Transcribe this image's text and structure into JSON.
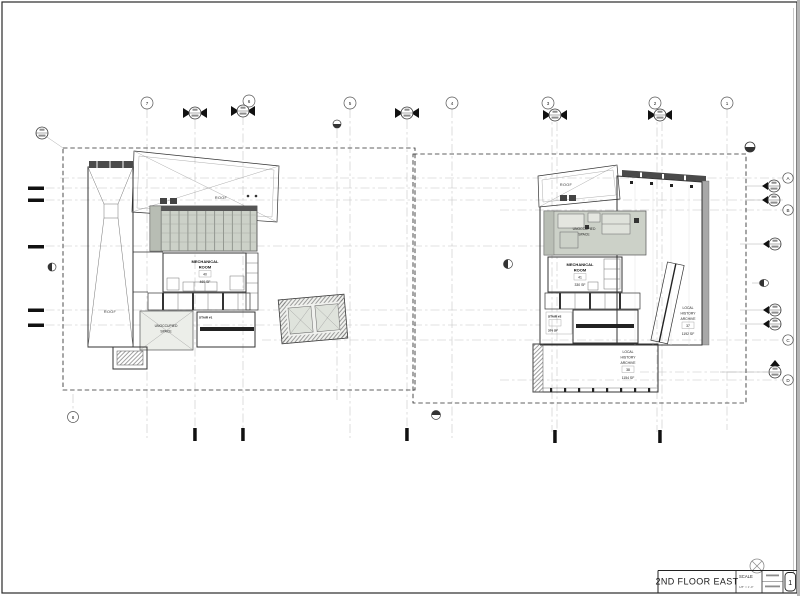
{
  "sheet": {
    "title": "2ND FLOOR EAST",
    "number": "1",
    "scale_label": "SCALE",
    "scale_value": "1/8\" = 1'-0\""
  },
  "grids": {
    "top": [
      "7",
      "6",
      "5",
      "4",
      "3",
      "2",
      "1"
    ],
    "right": [
      "A",
      "B",
      "C",
      "D"
    ],
    "bottom_left": "8"
  },
  "left_plan": {
    "roof_canopy": "ROOF",
    "roof_strip": "ROOF",
    "mech_1": "MECHANICAL",
    "mech_2": "ROOM",
    "mech_no": "40",
    "mech_area": "460 SF",
    "unocc_1": "UNOCCUPIED",
    "unocc_2": "SPACE",
    "stair": "STAIR #1"
  },
  "right_plan": {
    "roof": "ROOF",
    "unocc_1": "UNOCCUPIED",
    "unocc_2": "SPACE",
    "mech_1": "MECHANICAL",
    "mech_2": "ROOM",
    "mech_no": "41",
    "mech_area": "330 SF",
    "stair": "STAIR #2",
    "stair_area": "376 SF",
    "archive_e_1": "LOCAL",
    "archive_e_2": "HISTORY",
    "archive_e_3": "ARCHIVE",
    "archive_e_no": "37",
    "archive_e_area": "1192 SF",
    "archive_s_1": "LOCAL",
    "archive_s_2": "HISTORY",
    "archive_s_3": "ARCHIVE",
    "archive_s_no": "38",
    "archive_s_area": "1154 SF"
  }
}
